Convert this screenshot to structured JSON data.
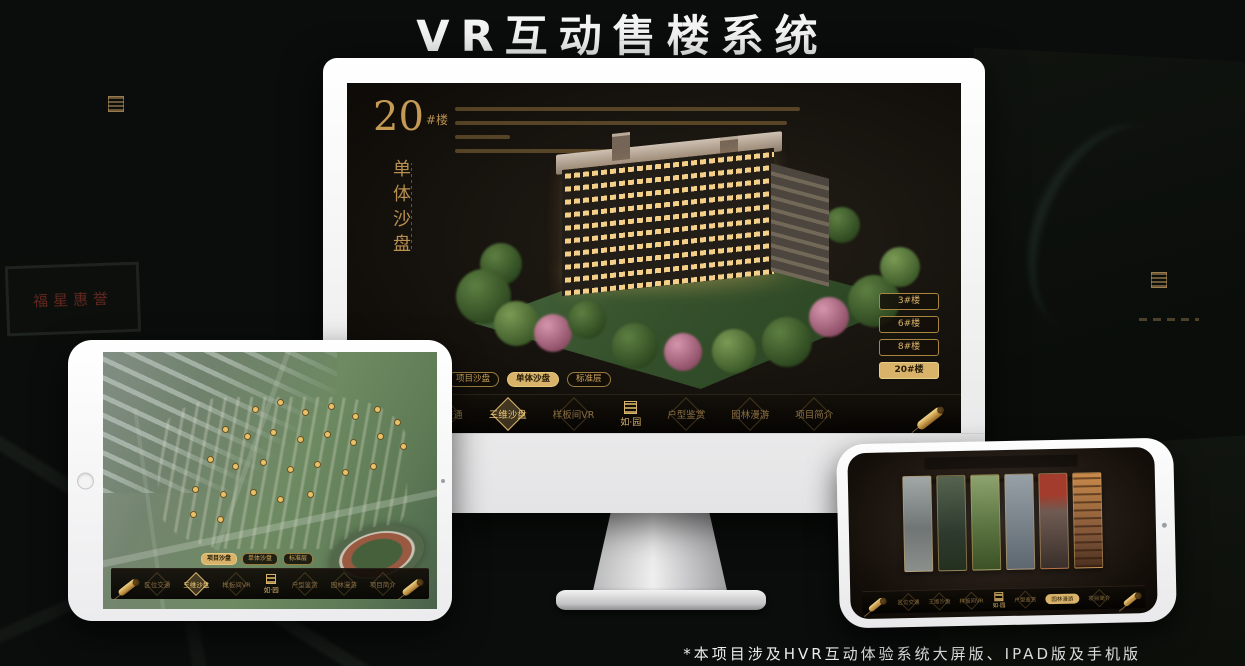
{
  "page": {
    "title": "VR互动售楼系统",
    "footnote": "*本项目涉及HVR互动体验系统大屏版、IPAD版及手机版"
  },
  "background": {
    "sign_text": "福星惠誉"
  },
  "colors": {
    "gold": "#d9b36a",
    "gold_dim": "#8a6f42",
    "screen_bg": "#16120d"
  },
  "sales_ui": {
    "heading": {
      "number": "20",
      "suffix": "#楼",
      "title_vertical": "单体沙盘"
    },
    "floor_buttons": [
      {
        "label": "3#楼",
        "active": false
      },
      {
        "label": "6#楼",
        "active": false
      },
      {
        "label": "8#楼",
        "active": false
      },
      {
        "label": "20#楼",
        "active": true
      }
    ],
    "subtabs": [
      {
        "label": "项目沙盘"
      },
      {
        "label": "单体沙盘"
      },
      {
        "label": "标准层"
      }
    ],
    "nav_items": [
      {
        "label": "区位交通"
      },
      {
        "label": "三维沙盘"
      },
      {
        "label": "样板间VR"
      },
      {
        "label": "户型鉴赏"
      },
      {
        "label": "园林漫游"
      },
      {
        "label": "项目简介"
      }
    ],
    "logo_text": "如·园"
  }
}
